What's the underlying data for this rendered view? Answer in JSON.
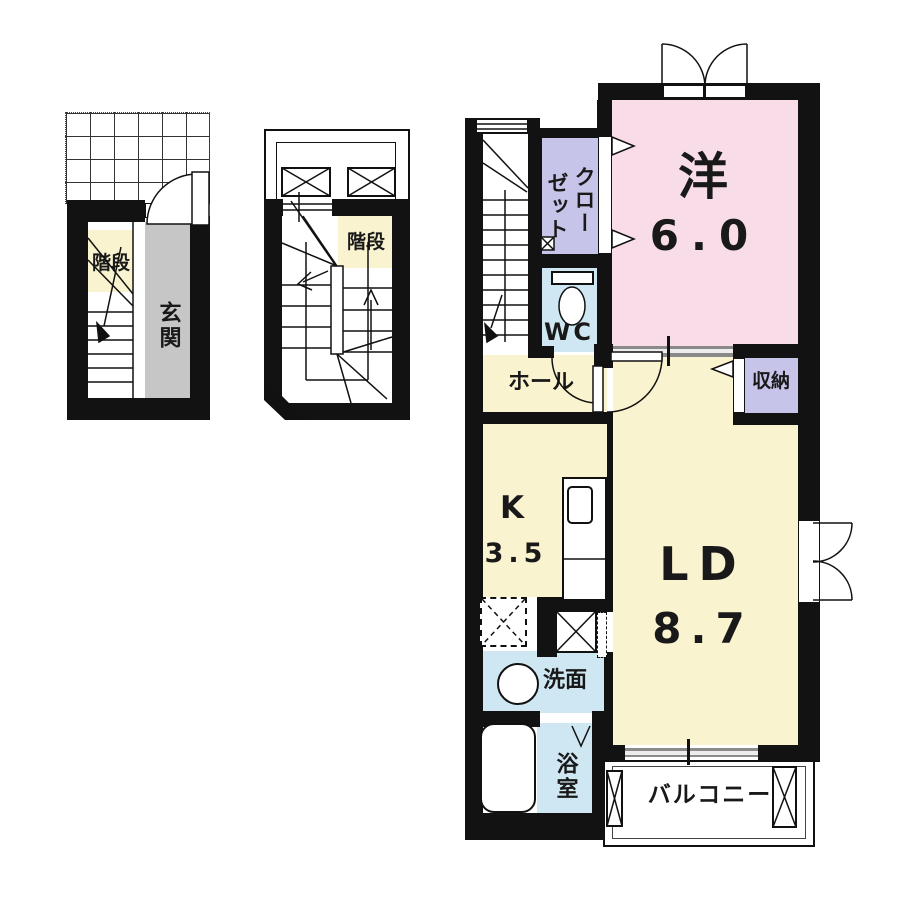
{
  "floorplan": {
    "floor1": {
      "stairs": "階段",
      "entrance": "玄関"
    },
    "floor2": {
      "stairs": "階段"
    },
    "floor3": {
      "closet_col_1": "クロー",
      "closet_col_2": "ゼット",
      "wc": "WC",
      "western_room": "洋",
      "western_room_size": "6.0",
      "hall": "ホール",
      "storage": "収納",
      "kitchen": "K",
      "kitchen_size": "3.5",
      "living_dining": "LD",
      "living_dining_size": "8.7",
      "washroom": "洗面",
      "bathroom": "浴室",
      "balcony": "バルコニー"
    },
    "colors": {
      "wall": "#121212",
      "western_room_pink": "#f8dce8",
      "room_yellow": "#faf3cf",
      "closet_lavender": "#c7c4ea",
      "wet_area_blue": "#cfe7f2",
      "entrance_gray": "#c6c6c6",
      "sliding_door_gray": "#8a8a8a"
    }
  }
}
